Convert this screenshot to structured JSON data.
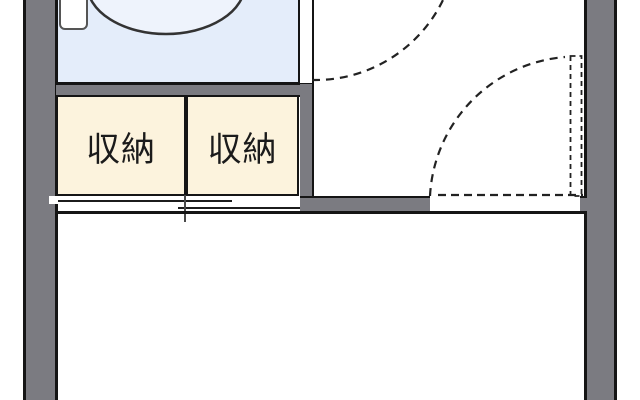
{
  "floorplan": {
    "closets": [
      {
        "label": "収納"
      },
      {
        "label": "収納"
      }
    ],
    "fixtures": {
      "toilet": "toilet-icon"
    },
    "doors": {
      "closet_door": "sliding-door",
      "top_door": "hinged-door-swing-arc",
      "right_door": "hinged-door-swing-arc-dashed-panel"
    },
    "colors": {
      "wall": "#7b7b81",
      "outline": "#151515",
      "bathroom_fill": "#e4edfa",
      "bowl_fill": "#eef3fc",
      "closet_fill": "#fcf3dd",
      "line_dark": "#222222"
    }
  }
}
